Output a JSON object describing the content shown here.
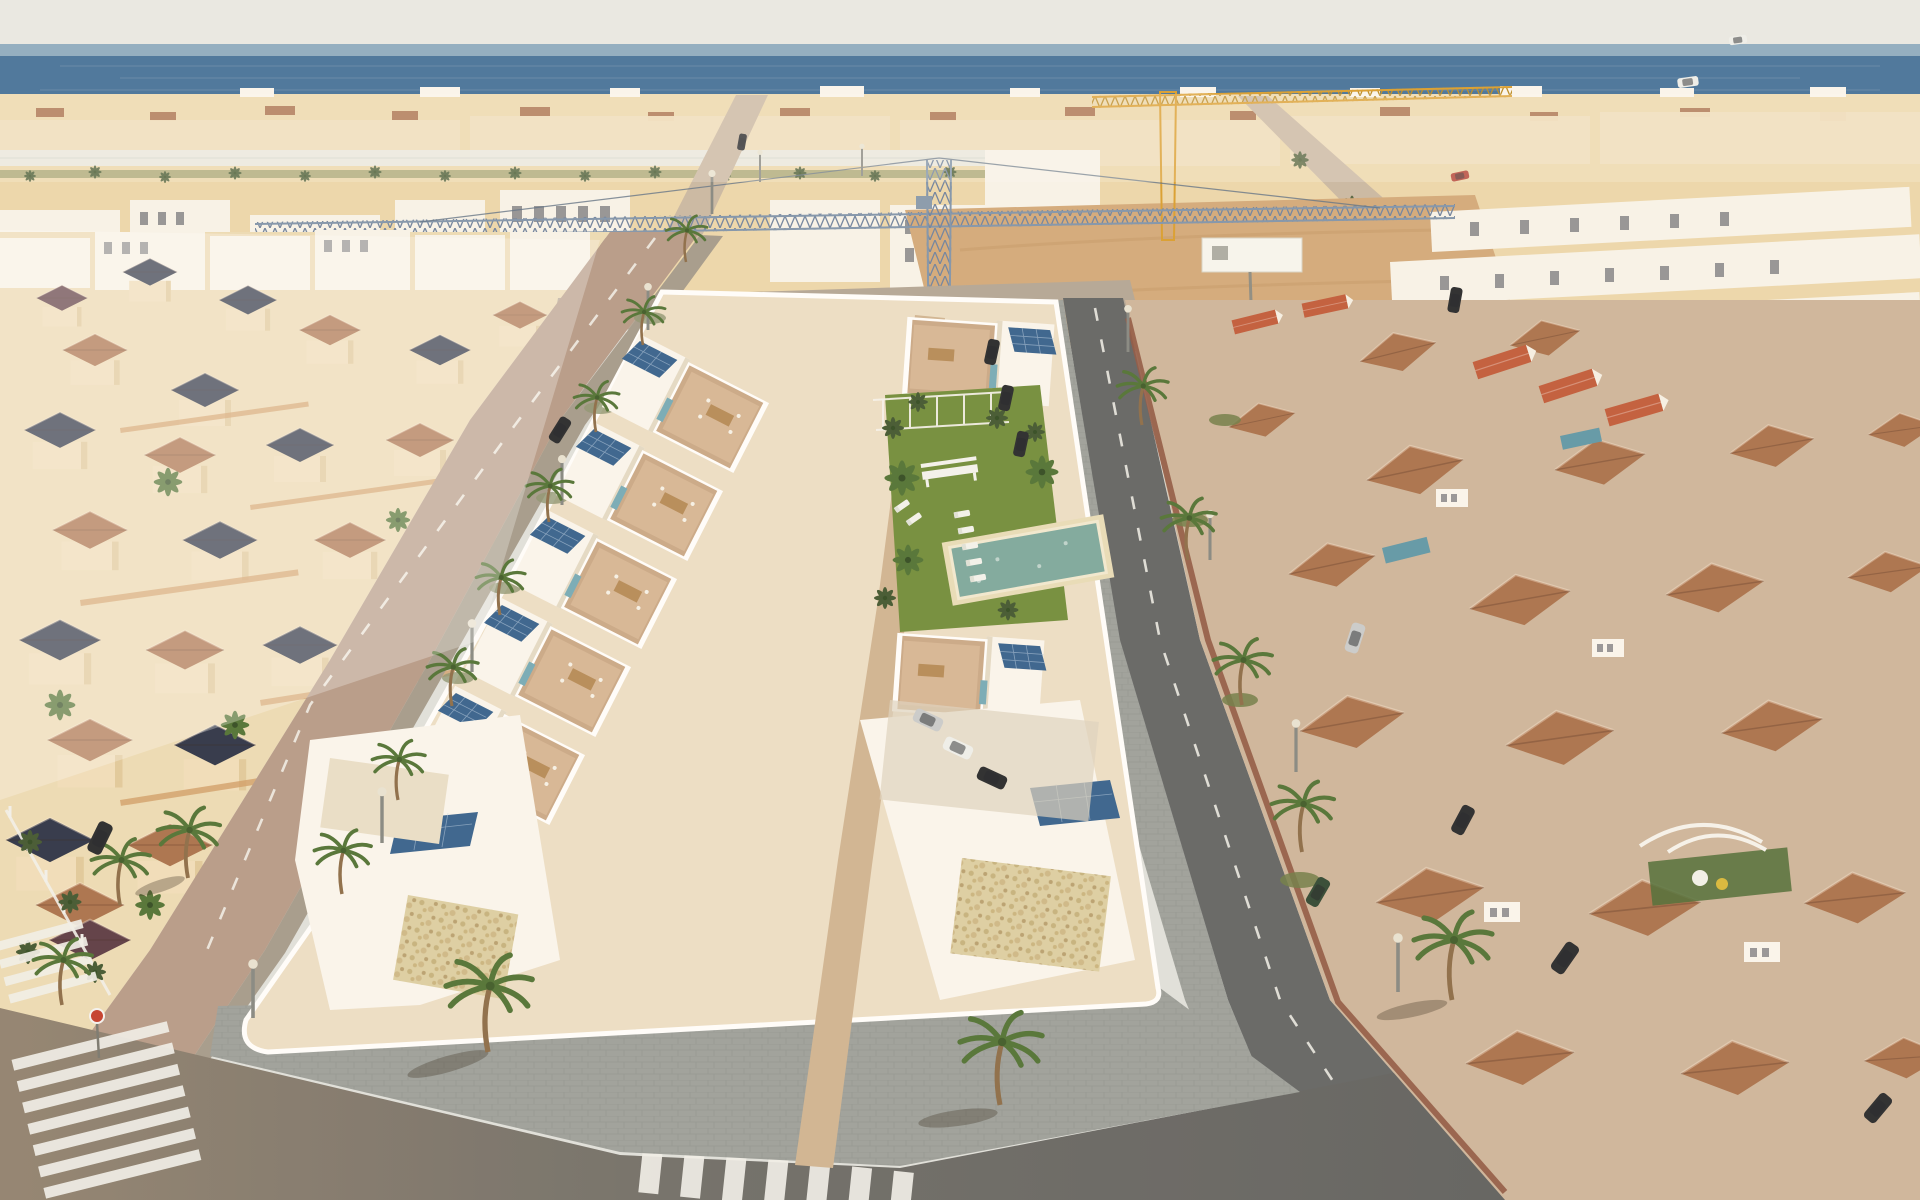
{
  "meta": {
    "title": "Aerial 3D render of a coastal residential development",
    "kind": "architectural-visualisation photo, no text or UI overlays",
    "view": "high oblique aerial looking toward the sea"
  },
  "scene": {
    "background": [
      "hazy sky",
      "sea horizon band",
      "dense low-rise coastal town",
      "greenhouse band",
      "palm rows"
    ],
    "construction": [
      "blue tower crane with long lattice jib",
      "yellow crane near shore",
      "empty sandy plot",
      "white billboard on posts"
    ],
    "left_neighborhood": [
      "cream Spanish villas",
      "navy and terracotta pyramid roofs",
      "palm trees",
      "white picket fence"
    ],
    "new_development": [
      "two rows of white modern villas",
      "beige roof terraces with furniture",
      "rooftop solar panels",
      "teal accent panels",
      "central paved walkway",
      "communal lawn with pool, loungers, bench and pergola",
      "stone-clad feature walls",
      "white perimeter wall"
    ],
    "right_neighborhood": [
      "terracotta tiled hip roofs",
      "red gable roofs",
      "white dormers",
      "brick boundary walls",
      "small private pools",
      "play canopy"
    ],
    "streets": [
      "palm-lined avenue on the left",
      "avenue on the right with parked cars",
      "front road with paver sidewalk",
      "zebra crossings",
      "lane arrows",
      "round red traffic sign",
      "street lamps"
    ]
  },
  "palette": {
    "sky": "#e9eae7",
    "sea": "#44739d",
    "sea_haze": "#a6c0d0",
    "town": "#ecd8ad",
    "white_bldg": "#f8f5ec",
    "cream_bldg": "#f0debc",
    "ground_cream": "#ecdcb6",
    "roof_navy": "#2a3247",
    "roof_terracotta": "#a8704c",
    "roof_red": "#c05a3a",
    "roof_maroon": "#5a3a44",
    "asphalt": "#606365",
    "warm_road": "#b59a89",
    "cross_road": "#b2a697",
    "paver": "#9ba09d",
    "site_ground": "#ecdfc8",
    "walkway": "#cfb493",
    "terrace": "#c9a888",
    "solar": "#33608e",
    "teal": "#74aab8",
    "lawn": "#6f8c3b",
    "pool": "#7ba89f",
    "pool_private": "#5d97a8",
    "palm": "#4e7134",
    "tree_dark": "#3f5530",
    "dirt": "#d2a97b",
    "crane_yellow": "#d99e2e",
    "crane_blue": "#7e94ad",
    "brick": "#8e5543",
    "car_dark": "#24272c",
    "car_silver": "#c9ccce",
    "car_white": "#eef0ee",
    "car_green": "#2e4633",
    "car_red": "#b03a2e",
    "sign_red": "#c23b2a",
    "wall_white": "#ffffff",
    "billboard": "#f7f7f2"
  }
}
